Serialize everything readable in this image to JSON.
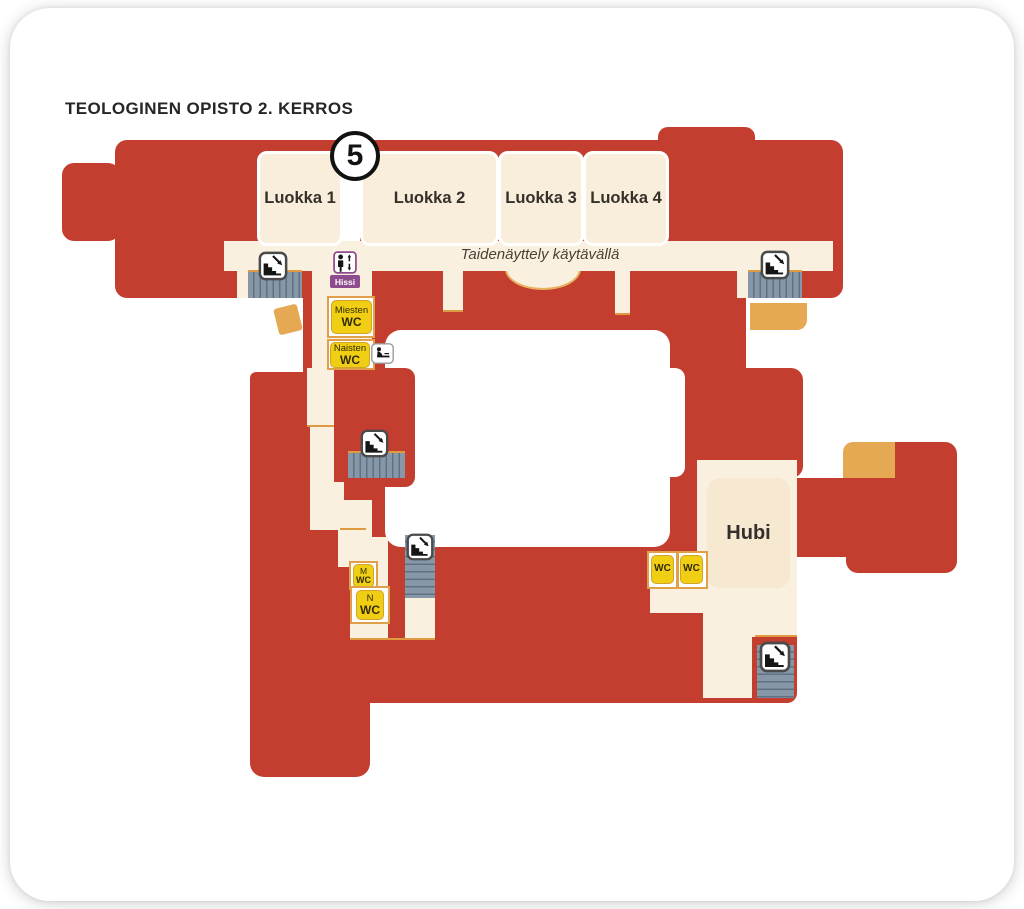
{
  "title": "TEOLOGINEN OPISTO 2. KERROS",
  "floor_badge": "5",
  "rooms": {
    "classrooms": [
      {
        "label": "Luokka 1"
      },
      {
        "label": "Luokka 2"
      },
      {
        "label": "Luokka 3"
      },
      {
        "label": "Luokka 4"
      }
    ],
    "hub": {
      "label": "Hubi"
    }
  },
  "corridor": {
    "note": "Taidenäyttely käytävällä"
  },
  "signs": {
    "elevator": {
      "label": "Hissi",
      "icon": "elevator-person-up-down-arrows"
    },
    "mens_wc": {
      "line1": "Miesten",
      "line2": "WC"
    },
    "womens_wc": {
      "line1": "Naisten",
      "line2": "WC"
    },
    "baby_change": {
      "icon": "baby-changing-station"
    },
    "m_wc": {
      "line1": "M",
      "line2": "WC"
    },
    "n_wc": {
      "line1": "N",
      "line2": "WC"
    },
    "wc_left": {
      "label": "WC"
    },
    "wc_right": {
      "label": "WC"
    },
    "stairs_icon": "stairs-descending-with-arrow",
    "stairs_count": 5
  },
  "colors": {
    "building_red": "#C43E30",
    "room_cream": "#FAF0DF",
    "stairs_gray": "#8697A8",
    "wc_yellow": "#EFCE13",
    "elevator_purple": "#8E4B8D",
    "ramp_tan": "#E5A853",
    "wall_orange": "#E09A42"
  }
}
